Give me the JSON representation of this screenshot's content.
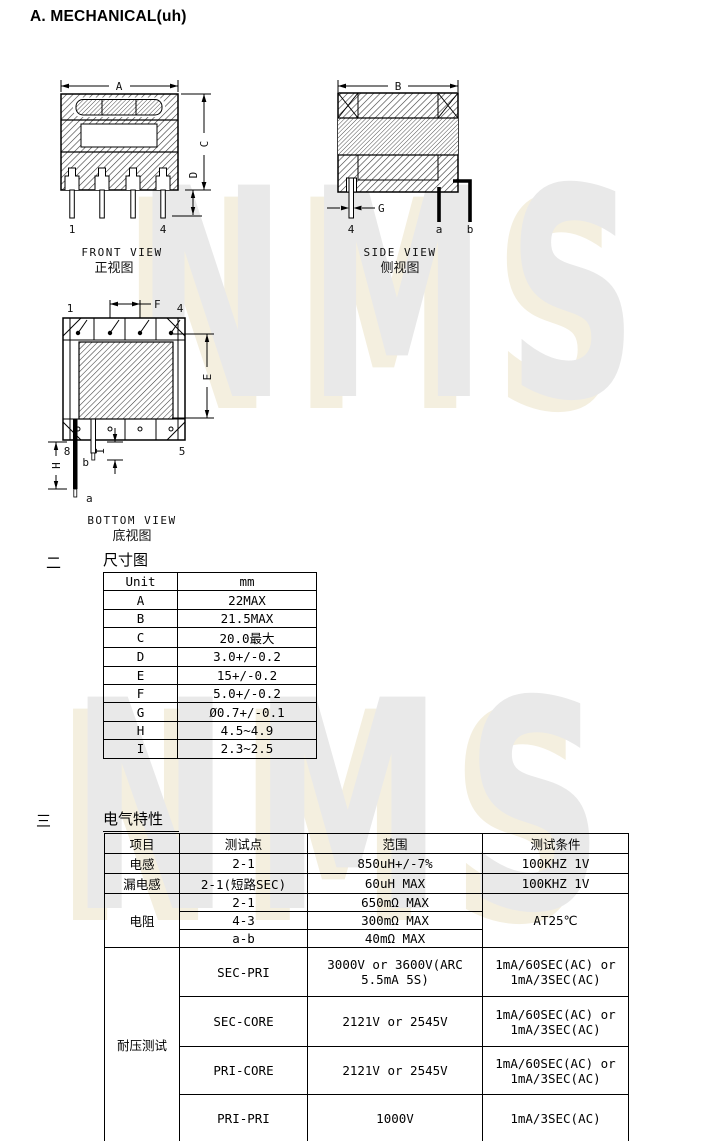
{
  "page": {
    "title": "A. MECHANICAL(uh)"
  },
  "watermark": {
    "text": "NMS",
    "gray": "#e9e9e9",
    "cream": "#f4efdf"
  },
  "views": {
    "front": {
      "title_en": "FRONT VIEW",
      "title_zh": "正视图",
      "dim_width": "A",
      "dim_height": "C",
      "dim_standoff": "D",
      "pin_left": "1",
      "pin_right": "4"
    },
    "side": {
      "title_en": "SIDE VIEW",
      "title_zh": "侧视图",
      "dim_width": "B",
      "dim_pin_dia": "G",
      "pin": "4",
      "lead_a": "a",
      "lead_b": "b"
    },
    "bottom": {
      "title_en": "BOTTOM VIEW",
      "title_zh": "底视图",
      "pin_top_left": "1",
      "pin_top_right": "4",
      "pin_bottom_left": "8",
      "pin_bottom_right": "5",
      "dim_pitch": "F",
      "dim_body": "E",
      "dim_lead": "H",
      "dim_lead2": "I",
      "lead_a": "a",
      "lead_b": "b"
    }
  },
  "dimensions_section": {
    "marker": "二",
    "title": "尺寸图",
    "table": {
      "col_unit": "Unit",
      "col_mm": "mm",
      "rows": [
        {
          "name": "A",
          "value": "22MAX"
        },
        {
          "name": "B",
          "value": "21.5MAX"
        },
        {
          "name": "C",
          "value": "20.0最大"
        },
        {
          "name": "D",
          "value": "3.0+/-0.2"
        },
        {
          "name": "E",
          "value": "15+/-0.2"
        },
        {
          "name": "F",
          "value": "5.0+/-0.2"
        },
        {
          "name": "G",
          "value": "Ø0.7+/-0.1"
        },
        {
          "name": "H",
          "value": "4.5~4.9"
        },
        {
          "name": "I",
          "value": "2.3~2.5"
        }
      ]
    }
  },
  "electrical_section": {
    "marker": "三",
    "title": "电气特性",
    "table": {
      "headers": {
        "item": "项目",
        "test_point": "测试点",
        "range": "范围",
        "condition": "测试条件"
      },
      "inductance": {
        "item": "电感",
        "point": "2-1",
        "range": "850uH+/-7%",
        "condition": "100KHZ 1V"
      },
      "leakage": {
        "item": "漏电感",
        "point": "2-1(短路SEC)",
        "range": "60uH MAX",
        "condition": "100KHZ 1V"
      },
      "resistance": {
        "item": "电阻",
        "condition": "AT25℃",
        "rows": [
          {
            "point": "2-1",
            "range": "650mΩ MAX"
          },
          {
            "point": "4-3",
            "range": "300mΩ MAX"
          },
          {
            "point": "a-b",
            "range": "40mΩ MAX"
          }
        ]
      },
      "hipot": {
        "item": "耐压测试",
        "rows": [
          {
            "point": "SEC-PRI",
            "range": "3000V or 3600V(ARC 5.5mA 5S)",
            "condition": "1mA/60SEC(AC) or 1mA/3SEC(AC)"
          },
          {
            "point": "SEC-CORE",
            "range": "2121V or 2545V",
            "condition": "1mA/60SEC(AC) or 1mA/3SEC(AC)"
          },
          {
            "point": "PRI-CORE",
            "range": "2121V or 2545V",
            "condition": "1mA/60SEC(AC) or 1mA/3SEC(AC)"
          },
          {
            "point": "PRI-PRI",
            "range": "1000V",
            "condition": "1mA/3SEC(AC)"
          }
        ]
      }
    }
  }
}
